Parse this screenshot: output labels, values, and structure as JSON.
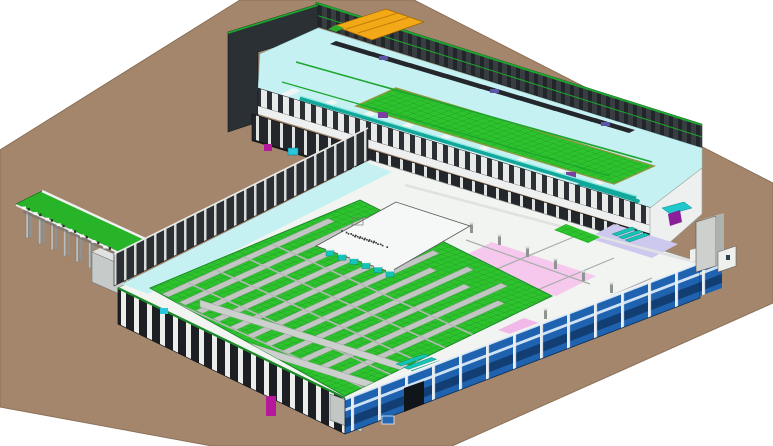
{
  "meta": {
    "description": "Axonometric 3D BIM model view of an L-shaped industrial plant: two long production halls in cutaway, loading canopy at left, utility tower at right, on a brown site pad",
    "view_type": "isometric-cutaway",
    "visible_text": "none"
  },
  "palette": {
    "canvas_white": "#ffffff",
    "ground": "#a3866c",
    "ground_edge": "#8c7159",
    "wall_dark": "#2b3034",
    "wall_back": "#3a3f44",
    "column_white": "#eceeec",
    "walkway_white": "#edf0ef",
    "floor_cyan": "#c6f1f2",
    "floor_green": "#2ec22e",
    "grid_green_line": "#17941c",
    "olive_wall": "#9aa048",
    "mezzanine_white": "#f2f4f2",
    "mezz_line": "#a8aeaa",
    "pink_zone": "#f6c8ee",
    "pink_zone2": "#f2b8e8",
    "lavender_zone": "#c9c4ec",
    "cabinet_blue": "#1e62b0",
    "cabinet_stripe": "#cfe2f4",
    "cabinet_dark": "#123e74",
    "teal_unit": "#14c4b4",
    "teal_pipe": "#11a79b",
    "teal_pipe_hi": "#8fe8e0",
    "green_trim": "#1ca62e",
    "canopy_green": "#28b428",
    "yellow_platform": "#f3a818",
    "yellow_seam": "#c27f08",
    "indigo_machine": "#5b55a8",
    "magenta_unit": "#b5189b",
    "purple_ramp": "#7d1f92",
    "tower_gray": "#cdd0cd",
    "tower_side": "#aeb2ae",
    "conveyor_gray": "#c2c6c2",
    "beam_gray": "#ccd0cc",
    "machinery_dark": "#23262b",
    "shed_gray": "#c6cac8",
    "door_gray": "#c2c6c4",
    "vent_roof_white": "#f6f8f7",
    "cyan_box": "#2bc6dc"
  },
  "components": {
    "site_ground": "brown site pad (parallelogram)",
    "north_hall": "upper production hall, cutaway roof, cyan floor, green grid bays, overhead machinery",
    "south_hall": "lower production hall, green grid floor with conveyor lines, white mezzanine, pink and lavender rooms",
    "cabinet_wall": "blue multi-bay electrical cabinet facade on south-east side",
    "loading_canopy": "green-roof loading canopy on columns, west side",
    "utility_tower": "free-standing gray utility tower, east side",
    "yellow_platform": "yellow equipment platform at hall roof, north-west end",
    "teal_vent_units": "teal louver vent banks on mezzanine",
    "purple_ramp": "purple access ramp at south-east",
    "magenta_units": "magenta utility boxes at wall bases"
  },
  "counts": {
    "canopy_columns": 9,
    "conveyor_lines": 11,
    "green_bays_north_hall": 2,
    "teal_vent_strips": 7
  }
}
